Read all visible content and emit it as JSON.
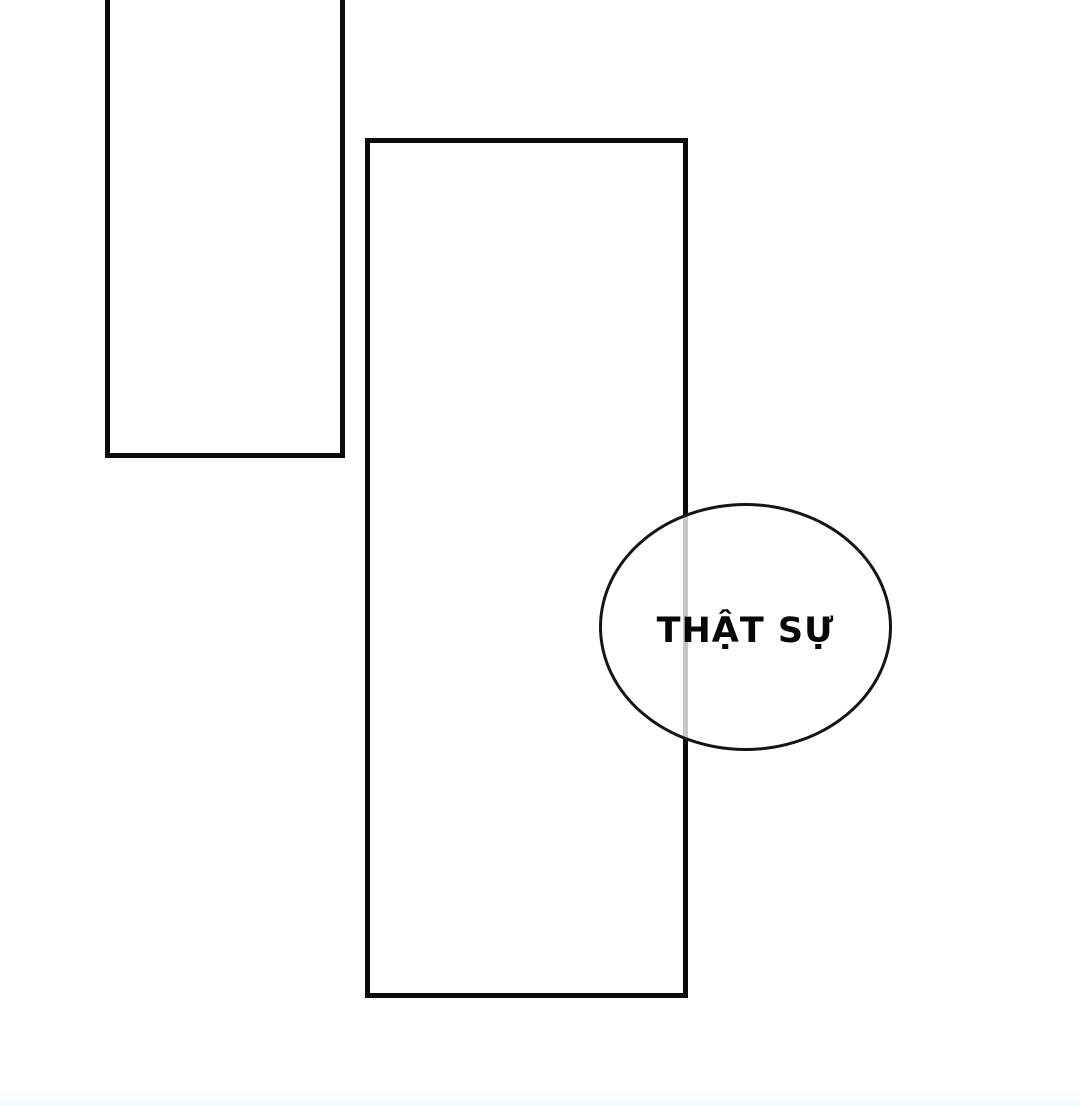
{
  "page": {
    "background": "#ffffff",
    "bottom_tint": "#e8f6fa"
  },
  "panels": [
    {
      "name": "panel-top-left",
      "border_color": "#0b0b0b",
      "fill": "#ffffff"
    },
    {
      "name": "panel-center",
      "border_color": "#0b0b0b",
      "fill": "#ffffff"
    }
  ],
  "speech_bubble": {
    "text": "THẬT SỰ",
    "outline_color": "#151515",
    "fill_color": "#ffffff",
    "text_color": "#070707"
  }
}
